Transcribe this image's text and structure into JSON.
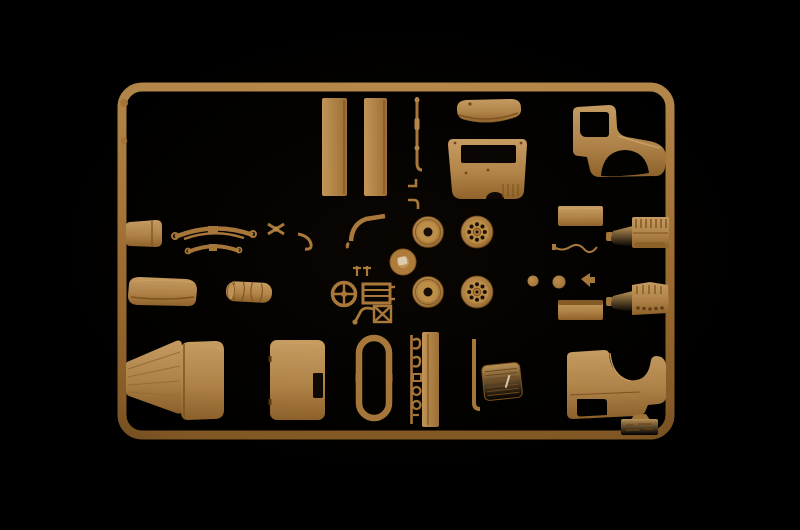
{
  "scene": {
    "description": "Photograph of a tan injection-molded plastic model-kit sprue (parts tree) for a military truck, lying on a black background",
    "background_color": "#000000",
    "plastic_base_color": "#c3924e",
    "plastic_highlight_color": "#dcae6e",
    "plastic_shadow_color": "#84541f",
    "runner_color": "#ad7737",
    "hole_color": "#0d0703"
  },
  "parts": {
    "frame": {
      "label": "rectangular sprue frame with rounded corners"
    },
    "bed_panel_1": {
      "label": "truck bed side board (left)"
    },
    "bed_panel_2": {
      "label": "truck bed side board (right)"
    },
    "cab_roof": {
      "label": "cab roof panel"
    },
    "cab_rear_panel": {
      "label": "cab rear panel with window opening"
    },
    "cab_side_upper": {
      "label": "cab side panel with door window and front fender (right side)"
    },
    "cab_side_lower": {
      "label": "cab side panel with door window and front fender (left side, inverted)"
    },
    "linkage_rod": {
      "label": "thin linkage rod"
    },
    "small_brackets": {
      "label": "small lever brackets"
    },
    "fuel_tank": {
      "label": "fuel tank box"
    },
    "leaf_spring_large": {
      "label": "large leaf spring"
    },
    "leaf_spring_small": {
      "label": "small leaf spring"
    },
    "transfer_case": {
      "label": "x-shaped chassis cross member"
    },
    "tow_hook": {
      "label": "curved tow hook"
    },
    "exhaust_pipe": {
      "label": "curved exhaust pipe"
    },
    "wheel_solid_1": {
      "label": "solid disc wheel (upper)"
    },
    "wheel_spoked_1": {
      "label": "perforated wheel rim (upper)"
    },
    "wheel_solid_2": {
      "label": "solid disc wheel (lower)"
    },
    "wheel_spoked_2": {
      "label": "perforated wheel rim (lower)"
    },
    "sprue_hub": {
      "label": "central sprue injection hub"
    },
    "door_plate_upper": {
      "label": "flat stowage-box panel (upper)"
    },
    "door_plate_lower": {
      "label": "flat stowage-box panel (lower)"
    },
    "engine_half_1": {
      "label": "engine block half with gearbox (upper)"
    },
    "engine_half_2": {
      "label": "engine block half with exhaust manifold (lower)"
    },
    "wiring_harness": {
      "label": "thin wiring / brake-line part"
    },
    "headlight_small": {
      "label": "small headlight"
    },
    "headlight_large": {
      "label": "large headlight"
    },
    "arrow_bracket": {
      "label": "arrow-shaped bracket"
    },
    "seat_backrest": {
      "label": "bench seat back cushion"
    },
    "canvas_roll": {
      "label": "rolled canvas tarpaulin"
    },
    "steering_wheel": {
      "label": "steering wheel"
    },
    "radiator_bracket": {
      "label": "ladder-shaped radiator bracket"
    },
    "x_brace": {
      "label": "small x-braced frame"
    },
    "pedal_lever": {
      "label": "pedal lever"
    },
    "clip_parts": {
      "label": "small T-shaped clips"
    },
    "engine_hood": {
      "label": "tapered engine hood side"
    },
    "cowl_panel": {
      "label": "hood top / cowl panel"
    },
    "cab_door": {
      "label": "cab door panel with pocket opening"
    },
    "window_frame": {
      "label": "elongated window frame ring"
    },
    "tow_hooks_set": {
      "label": "set of small hooks and shackle rings"
    },
    "running_board": {
      "label": "running board plank"
    },
    "radiator_rod": {
      "label": "radiator side rod"
    },
    "radiator_grille": {
      "label": "slatted radiator grille"
    },
    "marking_box": {
      "label": "small box with embossed maker markings"
    },
    "ejector_nubs": {
      "label": "round ejector nubs on frame edge"
    }
  }
}
